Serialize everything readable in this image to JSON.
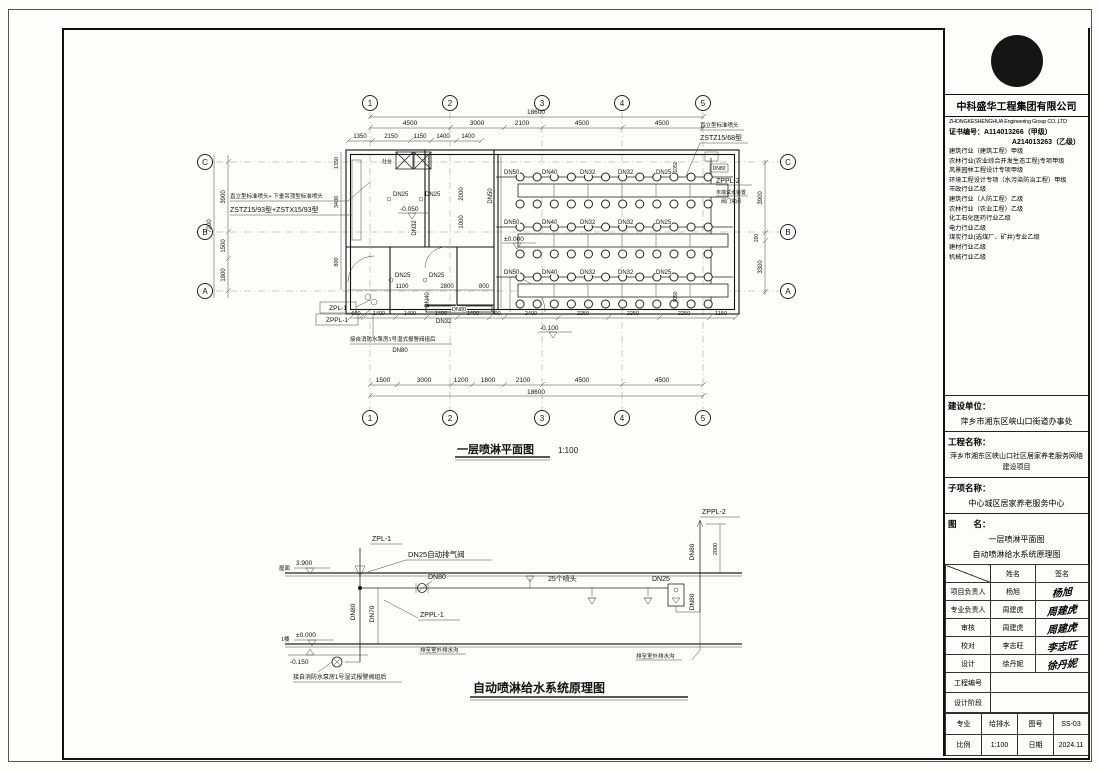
{
  "sheet": {
    "plan_title": "一层喷淋平面图",
    "plan_scale": "1:100",
    "schematic_title": "自动喷淋给水系统原理图"
  },
  "plan": {
    "grid_cols": [
      "1",
      "2",
      "3",
      "4",
      "5"
    ],
    "grid_rows": [
      "C",
      "B",
      "A"
    ],
    "overall_dim": "18600",
    "dims_top": [
      "4500",
      "3000",
      "2100",
      "4500",
      "4500"
    ],
    "dims_top2": [
      "1350",
      "2150",
      "1150",
      "1400",
      "1400"
    ],
    "dims_bottom": [
      "600",
      "1400",
      "1400",
      "1400",
      "1400",
      "700",
      "2400",
      "2250",
      "2250",
      "2250",
      "1150"
    ],
    "dims_bottom_grid": [
      "1500",
      "3000",
      "1200",
      "1800",
      "2100",
      "4500",
      "4500"
    ],
    "dims_left": [
      "3900",
      "7200",
      "1500",
      "1800"
    ],
    "dims_left_inner": [
      "1350",
      "3400",
      "800"
    ],
    "dims_right": [
      "3900",
      "200",
      "3300"
    ],
    "dims_interior": [
      "1100",
      "2800",
      "800",
      "2000",
      "1000",
      "1050",
      "1050"
    ],
    "branch_labels": [
      "DN50",
      "DN40",
      "DN32",
      "DN32",
      "DN25"
    ],
    "pipes": {
      "k1": "DN25",
      "k2": "DN25",
      "m1": "DN25",
      "m2": "DN25",
      "v_dn32": "DN32",
      "v_dn40": "DN40",
      "low_dn32": "DN32",
      "corridor": "DN80",
      "hall_main": "DN50",
      "right_top": "DN80"
    },
    "levels": {
      "kitchen": "-0.050",
      "hall": "±0.000",
      "outside": "-0.100"
    },
    "annotations": {
      "left1": "直立型标准喷头+ 下垂吊顶型标准喷头",
      "left2": "ZSTZ15/93型+ZSTX15/93型",
      "right1": "直立型标准喷头",
      "right2": "ZSTZ15/68型",
      "zppl2": "ZPPL-2",
      "end_test": "末端试水装置",
      "valve_closed": "阀门常闭",
      "zpl1": "ZPL-1",
      "zppl1": "ZPPL-1",
      "pump_note": "接自消防水泵房1号湿式报警阀组后",
      "pump_dn": "DN80",
      "stove": "灶台"
    }
  },
  "schematic": {
    "zpl1": "ZPL-1",
    "air_valve": "DN25自动排气阀",
    "roof_label": "屋面",
    "roof_level": "3.900",
    "floor_label": "1楼",
    "floor_level": "±0.000",
    "below_level": "-0.150",
    "dn80_branch": "DN80",
    "dn80_riser": "DN80",
    "dn70": "DN70",
    "zppl1": "ZPPL-1",
    "heads_note": "25个喷头",
    "dn25": "DN25",
    "zppl2": "ZPPL-2",
    "dn80_right": "DN80",
    "dn80_right2": "DN80",
    "dim_2000": "2000",
    "drain_note1": "排至室外排水沟",
    "drain_note2": "排至室外排水沟",
    "pump_note": "接自消防水泵房1号湿式报警阀组后"
  },
  "title_block": {
    "company_name": "中科盛华工程集团有限公司",
    "company_en": "ZHONGKESHENGHUA Engineering Group CO.,LTD",
    "cert_no_label": "证书编号：",
    "cert_no_1": "A114013266（甲级）",
    "cert_no_2": "A214013263（乙级）",
    "quals": [
      "建筑行业（建筑工程）甲级",
      "农林行业(农业综合开发生态工程)专项甲级",
      "风景园林工程设计专项甲级",
      "环境工程设计专项（水污染防治工程）甲级",
      "市政行业乙级",
      "建筑行业（人防工程）乙级",
      "农林行业（农业工程）乙级",
      "化工石化医药行业乙级",
      "电力行业乙级",
      "煤炭行业(选煤厂、矿井)专业乙级",
      "建材行业乙级",
      "机械行业乙级"
    ],
    "sections": {
      "build_unit_label": "建设单位：",
      "build_unit": "萍乡市湘东区峡山口街道办事处",
      "project_label": "工程名称：",
      "project": "萍乡市湘东区峡山口社区居家养老服务网络建设项目",
      "sub_label": "子项名称：",
      "sub": "中心城区居家养老服务中心",
      "drawing_label": "图　　名：",
      "drawing_1": "一层喷淋平面图",
      "drawing_2": "自动喷淋给水系统原理图"
    },
    "table": {
      "col_name": "姓名",
      "col_sign": "签名",
      "rows": [
        {
          "role": "项目负责人",
          "name": "杨旭",
          "sign": "杨旭"
        },
        {
          "role": "专业负责人",
          "name": "周建虎",
          "sign": "周建虎"
        },
        {
          "role": "审核",
          "name": "周建虎",
          "sign": "周建虎"
        },
        {
          "role": "校对",
          "name": "李志旺",
          "sign": "李志旺"
        },
        {
          "role": "设计",
          "name": "徐丹妮",
          "sign": "徐丹妮"
        }
      ],
      "project_no_label": "工程编号",
      "stage_label": "设计阶段",
      "major_label": "专业",
      "major": "给排水",
      "fig_no_label": "图号",
      "fig_no": "SS-03",
      "scale_label": "比例",
      "scale": "1:100",
      "date_label": "日期",
      "date": "2024.11"
    }
  }
}
